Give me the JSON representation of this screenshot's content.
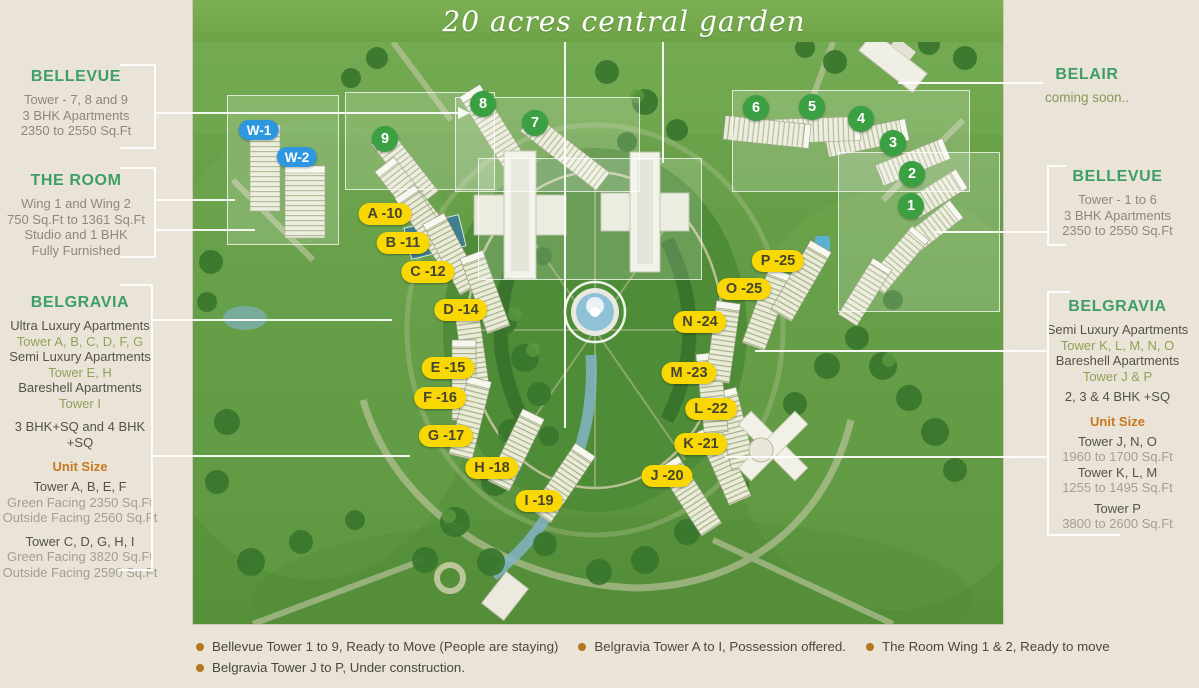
{
  "banner": {
    "title": "20 acres central garden"
  },
  "panels": {
    "left": {
      "bellevue": {
        "heading": "BELLEVUE",
        "lines": [
          {
            "text": "Tower - 7, 8 and 9",
            "style": "body"
          },
          {
            "text": "3 BHK Apartments",
            "style": "body"
          },
          {
            "text": "2350 to 2550 Sq.Ft",
            "style": "body"
          }
        ]
      },
      "the_room": {
        "heading": "THE ROOM",
        "lines": [
          {
            "text": "Wing 1 and Wing 2",
            "style": "body"
          },
          {
            "text": "750 Sq.Ft to 1361 Sq.Ft",
            "style": "body"
          },
          {
            "text": "Studio and 1 BHK",
            "style": "body"
          },
          {
            "text": "Fully Furnished",
            "style": "body"
          }
        ]
      },
      "belgravia": {
        "heading": "BELGRAVIA",
        "lines": [
          {
            "text": "Ultra Luxury Apartments",
            "style": "dark"
          },
          {
            "text": "Tower A, B, C, D, F, G",
            "style": "olive"
          },
          {
            "text": "Semi Luxury Apartments",
            "style": "dark"
          },
          {
            "text": "Tower E, H",
            "style": "olive"
          },
          {
            "text": "Bareshell Apartments",
            "style": "dark"
          },
          {
            "text": "Tower I",
            "style": "olive"
          },
          {
            "text": "3 BHK+SQ and 4 BHK +SQ",
            "style": "dark gap"
          }
        ],
        "unit_size_label": "Unit Size",
        "unit_lines": [
          {
            "text": "Tower A, B, E, F",
            "style": "dark gap-s"
          },
          {
            "text": "Green Facing 2350 Sq.Ft",
            "style": "muted"
          },
          {
            "text": "Outside Facing 2560 Sq.Ft",
            "style": "muted"
          },
          {
            "text": "Tower C, D, G, H, I",
            "style": "dark gap"
          },
          {
            "text": "Green Facing 3820 Sq.Ft",
            "style": "muted"
          },
          {
            "text": "Outside Facing 2590 Sq.Ft",
            "style": "muted"
          }
        ]
      }
    },
    "right": {
      "belair": {
        "heading": "BELAIR",
        "subtitle": "coming soon.."
      },
      "bellevue": {
        "heading": "BELLEVUE",
        "lines": [
          {
            "text": "Tower - 1 to 6",
            "style": "body"
          },
          {
            "text": "3 BHK Apartments",
            "style": "body"
          },
          {
            "text": "2350 to 2550 Sq.Ft",
            "style": "body"
          }
        ]
      },
      "belgravia": {
        "heading": "BELGRAVIA",
        "lines": [
          {
            "text": "Semi Luxury Apartments",
            "style": "dark"
          },
          {
            "text": "Tower K, L, M, N, O",
            "style": "olive"
          },
          {
            "text": "Bareshell Apartments",
            "style": "dark"
          },
          {
            "text": "Tower J & P",
            "style": "olive"
          },
          {
            "text": "2, 3 & 4 BHK +SQ",
            "style": "dark gap-s"
          }
        ],
        "unit_size_label": "Unit Size",
        "unit_lines": [
          {
            "text": "Tower J, N, O",
            "style": "dark gap-s"
          },
          {
            "text": "1960 to 1700 Sq.Ft",
            "style": "muted"
          },
          {
            "text": "Tower K, L, M",
            "style": "dark"
          },
          {
            "text": "1255 to 1495 Sq.Ft",
            "style": "muted"
          },
          {
            "text": "Tower P",
            "style": "dark gap-s"
          },
          {
            "text": "3800 to 2600 Sq.Ft",
            "style": "muted"
          }
        ]
      }
    }
  },
  "map": {
    "badges": [
      {
        "label": "W-1",
        "type": "blue",
        "x": 66,
        "y": 130
      },
      {
        "label": "W-2",
        "type": "blue",
        "x": 104,
        "y": 157
      },
      {
        "label": "9",
        "type": "green",
        "x": 192,
        "y": 139
      },
      {
        "label": "8",
        "type": "green",
        "x": 290,
        "y": 104
      },
      {
        "label": "7",
        "type": "green",
        "x": 342,
        "y": 123
      },
      {
        "label": "6",
        "type": "green",
        "x": 563,
        "y": 108
      },
      {
        "label": "5",
        "type": "green",
        "x": 619,
        "y": 107
      },
      {
        "label": "4",
        "type": "green",
        "x": 668,
        "y": 119
      },
      {
        "label": "3",
        "type": "green",
        "x": 700,
        "y": 143
      },
      {
        "label": "2",
        "type": "green",
        "x": 719,
        "y": 174
      },
      {
        "label": "1",
        "type": "green",
        "x": 718,
        "y": 206
      },
      {
        "label": "A -10",
        "type": "yellow",
        "x": 192,
        "y": 214
      },
      {
        "label": "B -11",
        "type": "yellow",
        "x": 210,
        "y": 243
      },
      {
        "label": "C -12",
        "type": "yellow",
        "x": 235,
        "y": 272
      },
      {
        "label": "D -14",
        "type": "yellow",
        "x": 268,
        "y": 310
      },
      {
        "label": "E -15",
        "type": "yellow",
        "x": 255,
        "y": 368
      },
      {
        "label": "F -16",
        "type": "yellow",
        "x": 247,
        "y": 398
      },
      {
        "label": "G -17",
        "type": "yellow",
        "x": 253,
        "y": 436
      },
      {
        "label": "H -18",
        "type": "yellow",
        "x": 299,
        "y": 468
      },
      {
        "label": "I -19",
        "type": "yellow",
        "x": 346,
        "y": 501
      },
      {
        "label": "J -20",
        "type": "yellow",
        "x": 474,
        "y": 476
      },
      {
        "label": "K -21",
        "type": "yellow",
        "x": 508,
        "y": 444
      },
      {
        "label": "L -22",
        "type": "yellow",
        "x": 518,
        "y": 409
      },
      {
        "label": "M -23",
        "type": "yellow",
        "x": 496,
        "y": 373
      },
      {
        "label": "N -24",
        "type": "yellow",
        "x": 507,
        "y": 322
      },
      {
        "label": "O -25",
        "type": "yellow",
        "x": 551,
        "y": 289
      },
      {
        "label": "P -25",
        "type": "yellow",
        "x": 585,
        "y": 261
      }
    ]
  },
  "legend": {
    "rows": [
      [
        "Bellevue Tower 1 to 9, Ready to Move (People are staying)",
        "Belgravia Tower A to I, Possession offered.",
        "The Room Wing 1 & 2, Ready to move"
      ],
      [
        "Belgravia Tower J to P, Under construction."
      ]
    ]
  },
  "colors": {
    "heading_green": "#3f9e66",
    "unit_size_orange": "#c8791f",
    "badge_yellow": "#f8d702",
    "badge_green": "#3aa041",
    "badge_blue": "#2d97e0",
    "banner_green": "#75a84c",
    "bullet_orange": "#b5761f",
    "panel_bg": "#e9e4d7"
  }
}
